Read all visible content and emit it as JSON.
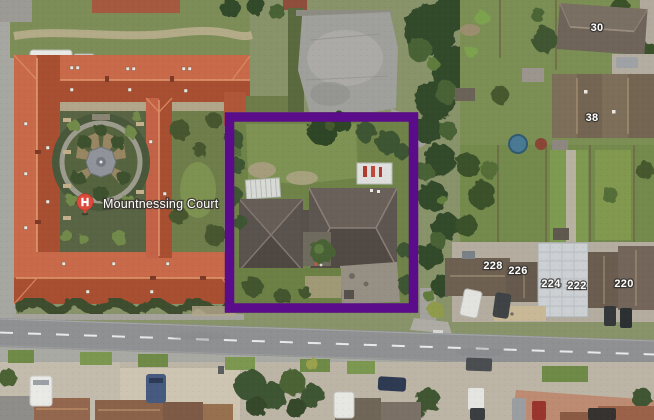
{
  "map": {
    "view_type": "satellite",
    "poi": {
      "label": "Mountnessing Court",
      "marker": "hospital-pin-icon",
      "marker_color": "#dc4a3c",
      "marker_letter": "H",
      "x": 85,
      "y": 202,
      "label_x": 103,
      "label_y": 208
    },
    "house_numbers": [
      {
        "text": "30",
        "x": 597,
        "y": 31
      },
      {
        "text": "38",
        "x": 592,
        "y": 121
      },
      {
        "text": "228",
        "x": 493,
        "y": 269
      },
      {
        "text": "226",
        "x": 518,
        "y": 274
      },
      {
        "text": "224",
        "x": 551,
        "y": 287
      },
      {
        "text": "222",
        "x": 577,
        "y": 289
      },
      {
        "text": "220",
        "x": 624,
        "y": 287
      }
    ],
    "highlight": {
      "x": 229.5,
      "y": 117,
      "width": 184,
      "height": 191,
      "color": "#5a0c8a",
      "stroke_width": 9.5
    },
    "label_style": {
      "text_color": "#ffffff",
      "halo_color": "#37342f"
    }
  }
}
